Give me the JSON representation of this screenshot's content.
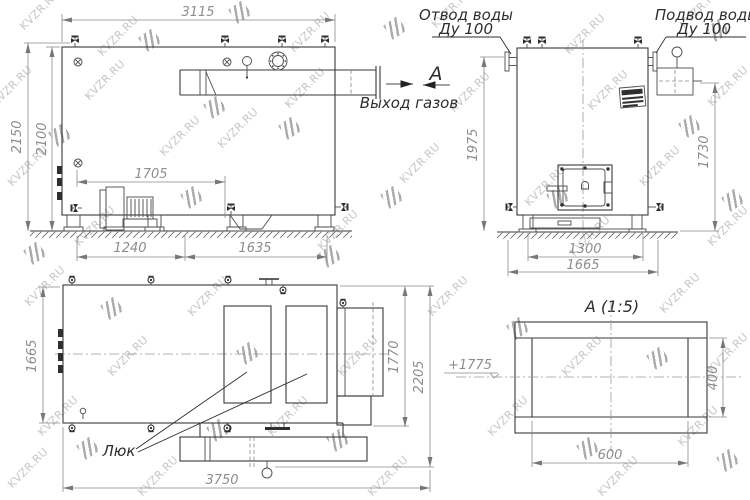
{
  "watermark": {
    "text": "KVZR.RU"
  },
  "side_view": {
    "dim_width_top": "3115",
    "dim_height_total": "2150",
    "dim_height_body": "2100",
    "dim_fan": "1705",
    "dim_base_left": "1240",
    "dim_base_right": "1635",
    "label_gas_outlet": "Выход газов",
    "label_section": "А"
  },
  "front_view": {
    "label_water_out_1": "Отвод воды",
    "label_water_out_2": "Ду 100",
    "label_water_in_1": "Подвод воды",
    "label_water_in_2": "Ду 100",
    "dim_height_left": "1975",
    "dim_height_right": "1730",
    "dim_base": "1300",
    "dim_width": "1665"
  },
  "plan_view": {
    "dim_depth": "1665",
    "dim_duct": "1770",
    "dim_total_depth": "2205",
    "dim_length": "3750",
    "label_hatch": "Люк"
  },
  "detail_view": {
    "title": "А  (1:5)",
    "elevation": "+1775",
    "dim_height": "400",
    "dim_width": "600"
  }
}
